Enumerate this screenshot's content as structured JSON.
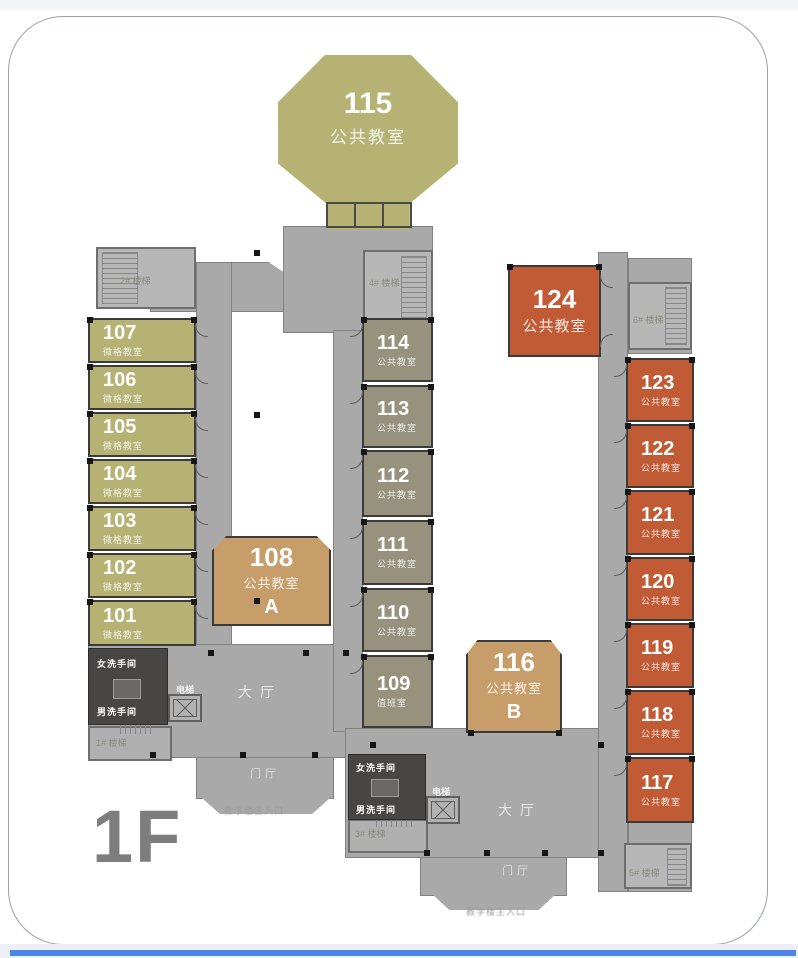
{
  "page": {
    "floor_label": "1F",
    "entrance_caption_left": "教学楼主入口",
    "entrance_caption_bottom": "教学楼主入口"
  },
  "halls": {
    "lobby": "大厅",
    "foyer": "门厅"
  },
  "stairs": {
    "s1": "1# 楼梯",
    "s2": "2# 楼梯",
    "s3": "3# 楼梯",
    "s4": "4# 楼梯",
    "s5": "5# 楼梯",
    "s6": "6# 楼梯"
  },
  "facilities": {
    "women_restroom": "女洗手间",
    "men_restroom": "男洗手间",
    "elevator": "电梯"
  },
  "feature_rooms": {
    "r115": {
      "number": "115",
      "label": "公共教室"
    },
    "r108": {
      "number": "108",
      "label": "公共教室",
      "letter": "A"
    },
    "r116": {
      "number": "116",
      "label": "公共教室",
      "letter": "B"
    },
    "r124": {
      "number": "124",
      "label": "公共教室"
    }
  },
  "left_wing_rooms": [
    {
      "number": "107",
      "label": "微格教室"
    },
    {
      "number": "106",
      "label": "微格教室"
    },
    {
      "number": "105",
      "label": "微格教室"
    },
    {
      "number": "104",
      "label": "微格教室"
    },
    {
      "number": "103",
      "label": "微格教室"
    },
    {
      "number": "102",
      "label": "微格教室"
    },
    {
      "number": "101",
      "label": "微格教室"
    }
  ],
  "middle_wing_rooms": [
    {
      "number": "114",
      "label": "公共教室"
    },
    {
      "number": "113",
      "label": "公共教室"
    },
    {
      "number": "112",
      "label": "公共教室"
    },
    {
      "number": "111",
      "label": "公共教室"
    },
    {
      "number": "110",
      "label": "公共教室"
    },
    {
      "number": "109",
      "label": "值班室"
    }
  ],
  "right_wing_rooms": [
    {
      "number": "123",
      "label": "公共教室"
    },
    {
      "number": "122",
      "label": "公共教室"
    },
    {
      "number": "121",
      "label": "公共教室"
    },
    {
      "number": "120",
      "label": "公共教室"
    },
    {
      "number": "119",
      "label": "公共教室"
    },
    {
      "number": "118",
      "label": "公共教室"
    },
    {
      "number": "117",
      "label": "公共教室"
    }
  ],
  "colors": {
    "micro_room": "#b5b274",
    "public_room_mid": "#97927e",
    "public_room_tan": "#c79d6a",
    "public_room_orange": "#c15b36",
    "corridor": "#a9a9a9",
    "dark_room": "#474645",
    "accent_line": "#4b86e8"
  }
}
